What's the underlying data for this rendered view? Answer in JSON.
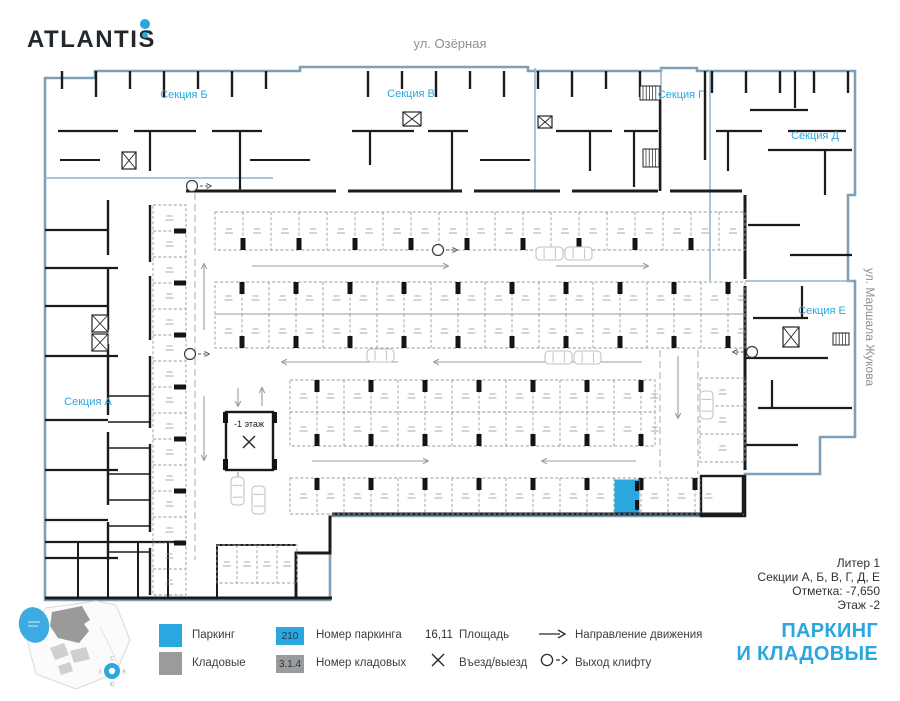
{
  "brand": {
    "name": "ATLANTIS"
  },
  "streets": {
    "top": "ул. Озёрная",
    "right": "ул. Маршала Жукова"
  },
  "plan": {
    "sections": [
      {
        "label": "Секция А"
      },
      {
        "label": "Секция Б"
      },
      {
        "label": "Секция В"
      },
      {
        "label": "Секция Г"
      },
      {
        "label": "Секция Д"
      },
      {
        "label": "Секция Е"
      }
    ],
    "ramp_label": "-1 этаж"
  },
  "info": {
    "liter": "Литер 1",
    "sections": "Секции А, Б, В, Г, Д, Е",
    "mark": "Отметка: -7,650",
    "floor": "Этаж -2"
  },
  "legend": {
    "parking": "Паркинг",
    "storage": "Кладовые",
    "parking_badge": "210",
    "parking_number": "Номер паркинга",
    "storage_badge": "3.1.4",
    "storage_number": "Номер кладовых",
    "area_value": "16,11",
    "area": "Площадь",
    "entry": "Въезд/выезд",
    "direction": "Направление движения",
    "lift_exit": "Выход клифту"
  },
  "title": {
    "line1": "ПАРКИНГ",
    "line2": "И КЛАДОВЫЕ"
  },
  "compass": {
    "n": "С",
    "e": "В",
    "s": "Ю",
    "w": "З"
  },
  "colors": {
    "accent": "#2AA7DF",
    "storage": "#9B9B9B",
    "outline": "#7E9FB6"
  }
}
